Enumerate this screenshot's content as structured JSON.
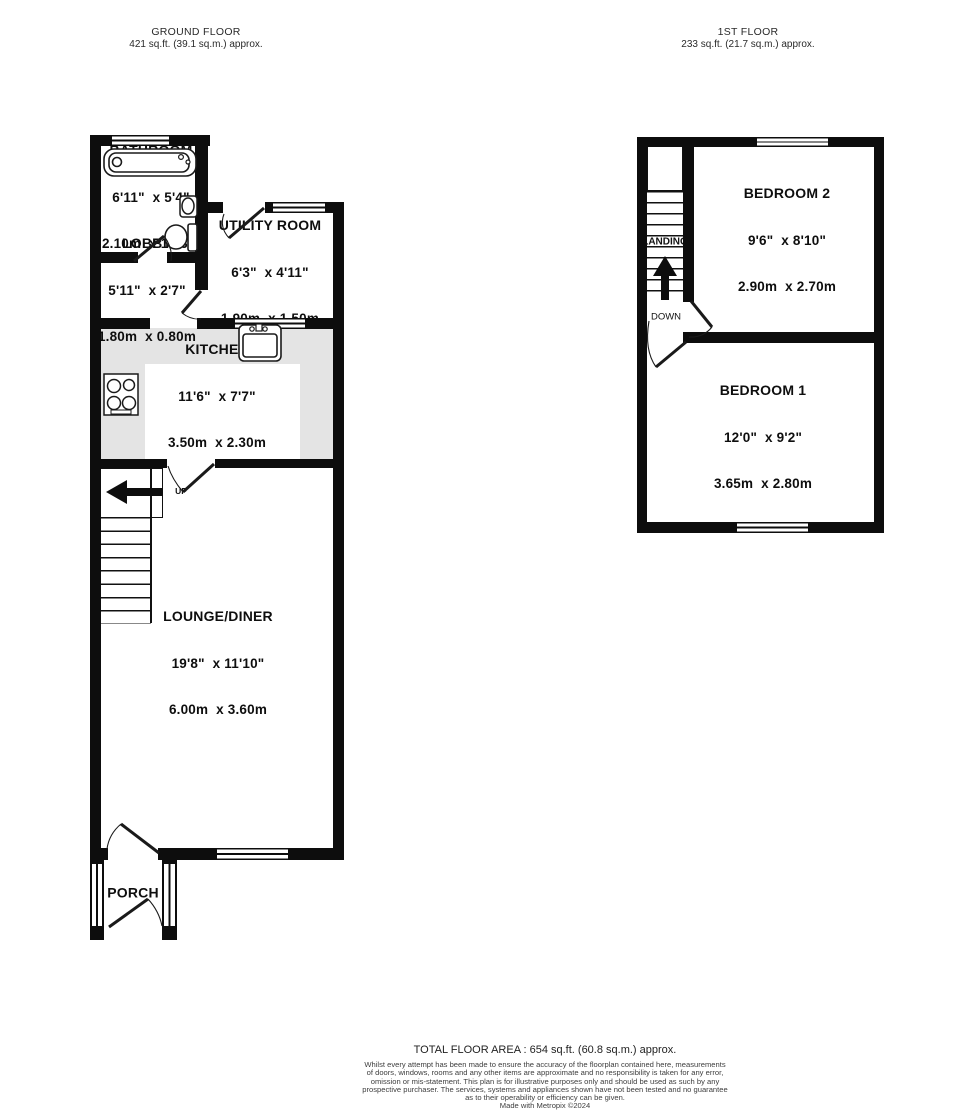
{
  "headers": {
    "ground": {
      "title": "GROUND FLOOR",
      "area": "421 sq.ft. (39.1 sq.m.) approx."
    },
    "first": {
      "title": "1ST FLOOR",
      "area": "233 sq.ft. (21.7 sq.m.) approx."
    }
  },
  "rooms": {
    "bathroom": {
      "name": "BATHROOM",
      "imperial": "6'11\"  x 5'4\"",
      "metric": "2.10m  x 1.63m"
    },
    "lobby": {
      "name": "LOBBY",
      "imperial": "5'11\"  x 2'7\"",
      "metric": "1.80m  x 0.80m"
    },
    "utility": {
      "name": "UTILITY ROOM",
      "imperial": "6'3\"  x 4'11\"",
      "metric": "1.90m  x 1.50m"
    },
    "kitchen": {
      "name": "KITCHEN",
      "imperial": "11'6\"  x 7'7\"",
      "metric": "3.50m  x 2.30m"
    },
    "lounge": {
      "name": "LOUNGE/DINER",
      "imperial": "19'8\"  x 11'10\"",
      "metric": "6.00m  x 3.60m"
    },
    "porch": {
      "name": "PORCH"
    },
    "bedroom2": {
      "name": "BEDROOM 2",
      "imperial": "9'6\"  x 8'10\"",
      "metric": "2.90m  x 2.70m"
    },
    "bedroom1": {
      "name": "BEDROOM 1",
      "imperial": "12'0\"  x 9'2\"",
      "metric": "3.65m  x 2.80m"
    }
  },
  "labels": {
    "up": "UP",
    "down": "DOWN",
    "landing": "LANDING"
  },
  "footer": {
    "total": "TOTAL FLOOR AREA : 654 sq.ft. (60.8 sq.m.) approx.",
    "line1": "Whilst every attempt has been made to ensure the accuracy of the floorplan contained here, measurements",
    "line2": "of doors, windows, rooms and any other items are approximate and no responsibility is taken for any error,",
    "line3": "omission or mis-statement. This plan is for illustrative purposes only and should be used as such by any",
    "line4": "prospective purchaser. The services, systems and appliances shown have not been tested and no guarantee",
    "line5": "as to their operability or efficiency can be given.",
    "credit": "Made with Metropix ©2024"
  },
  "colors": {
    "wall": "#0d0d0d",
    "counter": "#e4e4e4",
    "text": "#0e0e0e"
  }
}
